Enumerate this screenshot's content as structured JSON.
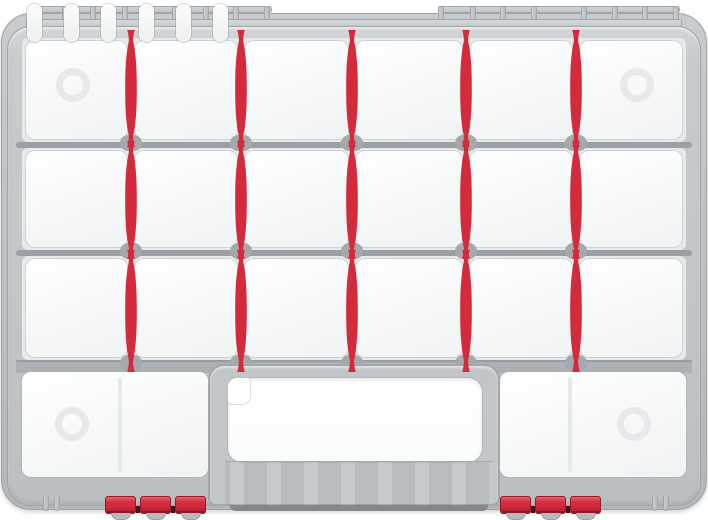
{
  "scene": {
    "name": "plastic-organizer-case",
    "description": "Top view of a closed gray plastic organizer case with white compartments, red adjustable spindle-shaped dividers, top hinge rail, bottom carry handle with grip slots, and two red three-segment latches",
    "visible_text": [],
    "colors": {
      "background": "#ffffff",
      "divider_red": "#d32b3c",
      "latch_red": "#d72e40",
      "latch_gap_dark": "#471017",
      "case_gray": "#c2c6c9",
      "frame_bar_gray": "#9aa0a4",
      "compartment_white": "#f7f8f9",
      "recess_ring": "#e7e9ec",
      "grip_slot_white": "#f3f4f5"
    },
    "counts": {
      "compartment_rows": 3,
      "compartment_columns": 6,
      "small_compartments": 18,
      "large_bottom_compartments": 2,
      "red_dividers": 15,
      "corner_recess_circles": 4,
      "grip_slots": 6,
      "latches": 2,
      "segments_per_latch": 3,
      "hinge_posts": 16,
      "hinge_rail_segments": 2
    },
    "geometry": {
      "stage": {
        "w": 708,
        "h": 520
      },
      "rim": {
        "x": 1,
        "y": 13,
        "w": 706,
        "h": 497
      },
      "case": {
        "x": 7,
        "y": 26,
        "w": 694,
        "h": 480
      },
      "col_bounds": [
        22,
        131,
        241,
        352,
        466,
        576,
        686
      ],
      "rows": [
        {
          "top": 38,
          "h": 104
        },
        {
          "top": 148,
          "h": 102
        },
        {
          "top": 256,
          "h": 104
        }
      ],
      "bars": [
        {
          "y": 142,
          "h": 6
        },
        {
          "y": 250,
          "h": 6
        }
      ],
      "bar_thick": {
        "y": 360,
        "h": 13
      },
      "bar_x": 16,
      "bar_w": 676,
      "divider_x": [
        131,
        241,
        352,
        466,
        576
      ],
      "divider_rows": [
        {
          "top": 30,
          "h": 117
        },
        {
          "top": 141,
          "h": 118
        },
        {
          "top": 250,
          "h": 122
        }
      ],
      "knob_y": [
        135,
        243,
        355
      ],
      "hinge": {
        "bar": {
          "x": 26,
          "y": 19,
          "w": 656,
          "h": 13
        },
        "top_bars": [
          {
            "x": 30,
            "y": 6,
            "w": 242,
            "h": 7
          },
          {
            "x": 438,
            "y": 6,
            "w": 242,
            "h": 7
          }
        ],
        "posts_x": [
          30,
          62,
          90,
          122,
          172,
          203,
          233,
          264,
          438,
          470,
          500,
          531,
          581,
          612,
          642,
          673
        ],
        "post": {
          "y": 6,
          "w": 6,
          "h": 16
        }
      },
      "bottom_row": {
        "top": 372,
        "h": 105,
        "left": {
          "x": 22,
          "w": 186,
          "line_x": 120,
          "circle_cx": 72
        },
        "right": {
          "x": 500,
          "w": 186,
          "line_x": 570,
          "circle_cx": 634
        },
        "circle_cy": 424
      },
      "recess_row1": {
        "cy": 85,
        "cx_left": 73,
        "cx_right": 637
      },
      "recess_d": 34,
      "recess_ring_w": 7,
      "handle": {
        "frame": {
          "x": 208,
          "y": 364,
          "w": 292,
          "h": 142
        },
        "cutout": {
          "x": 228,
          "y": 378,
          "w": 254,
          "h": 84
        },
        "notch": {
          "x": 228,
          "y": 378,
          "w": 22,
          "h": 26
        },
        "grip": {
          "x": 225,
          "y": 461,
          "w": 268,
          "h": 45
        },
        "slot": {
          "w": 15,
          "h": 38,
          "y": 465
        },
        "slot_cx": [
          259,
          296,
          333,
          371,
          408,
          445
        ],
        "understrip": {
          "x": 230,
          "y": 505,
          "w": 258,
          "h": 6
        }
      },
      "latch": {
        "y": 496,
        "seg_w": 31,
        "seg_h": 18,
        "pitch": 35,
        "segments": 3
      },
      "latches_x": [
        105,
        500
      ],
      "feet_hooks_x": [
        43,
        652
      ],
      "hook": {
        "y": 496,
        "w": 6,
        "h": 15,
        "gap": 11
      }
    }
  }
}
